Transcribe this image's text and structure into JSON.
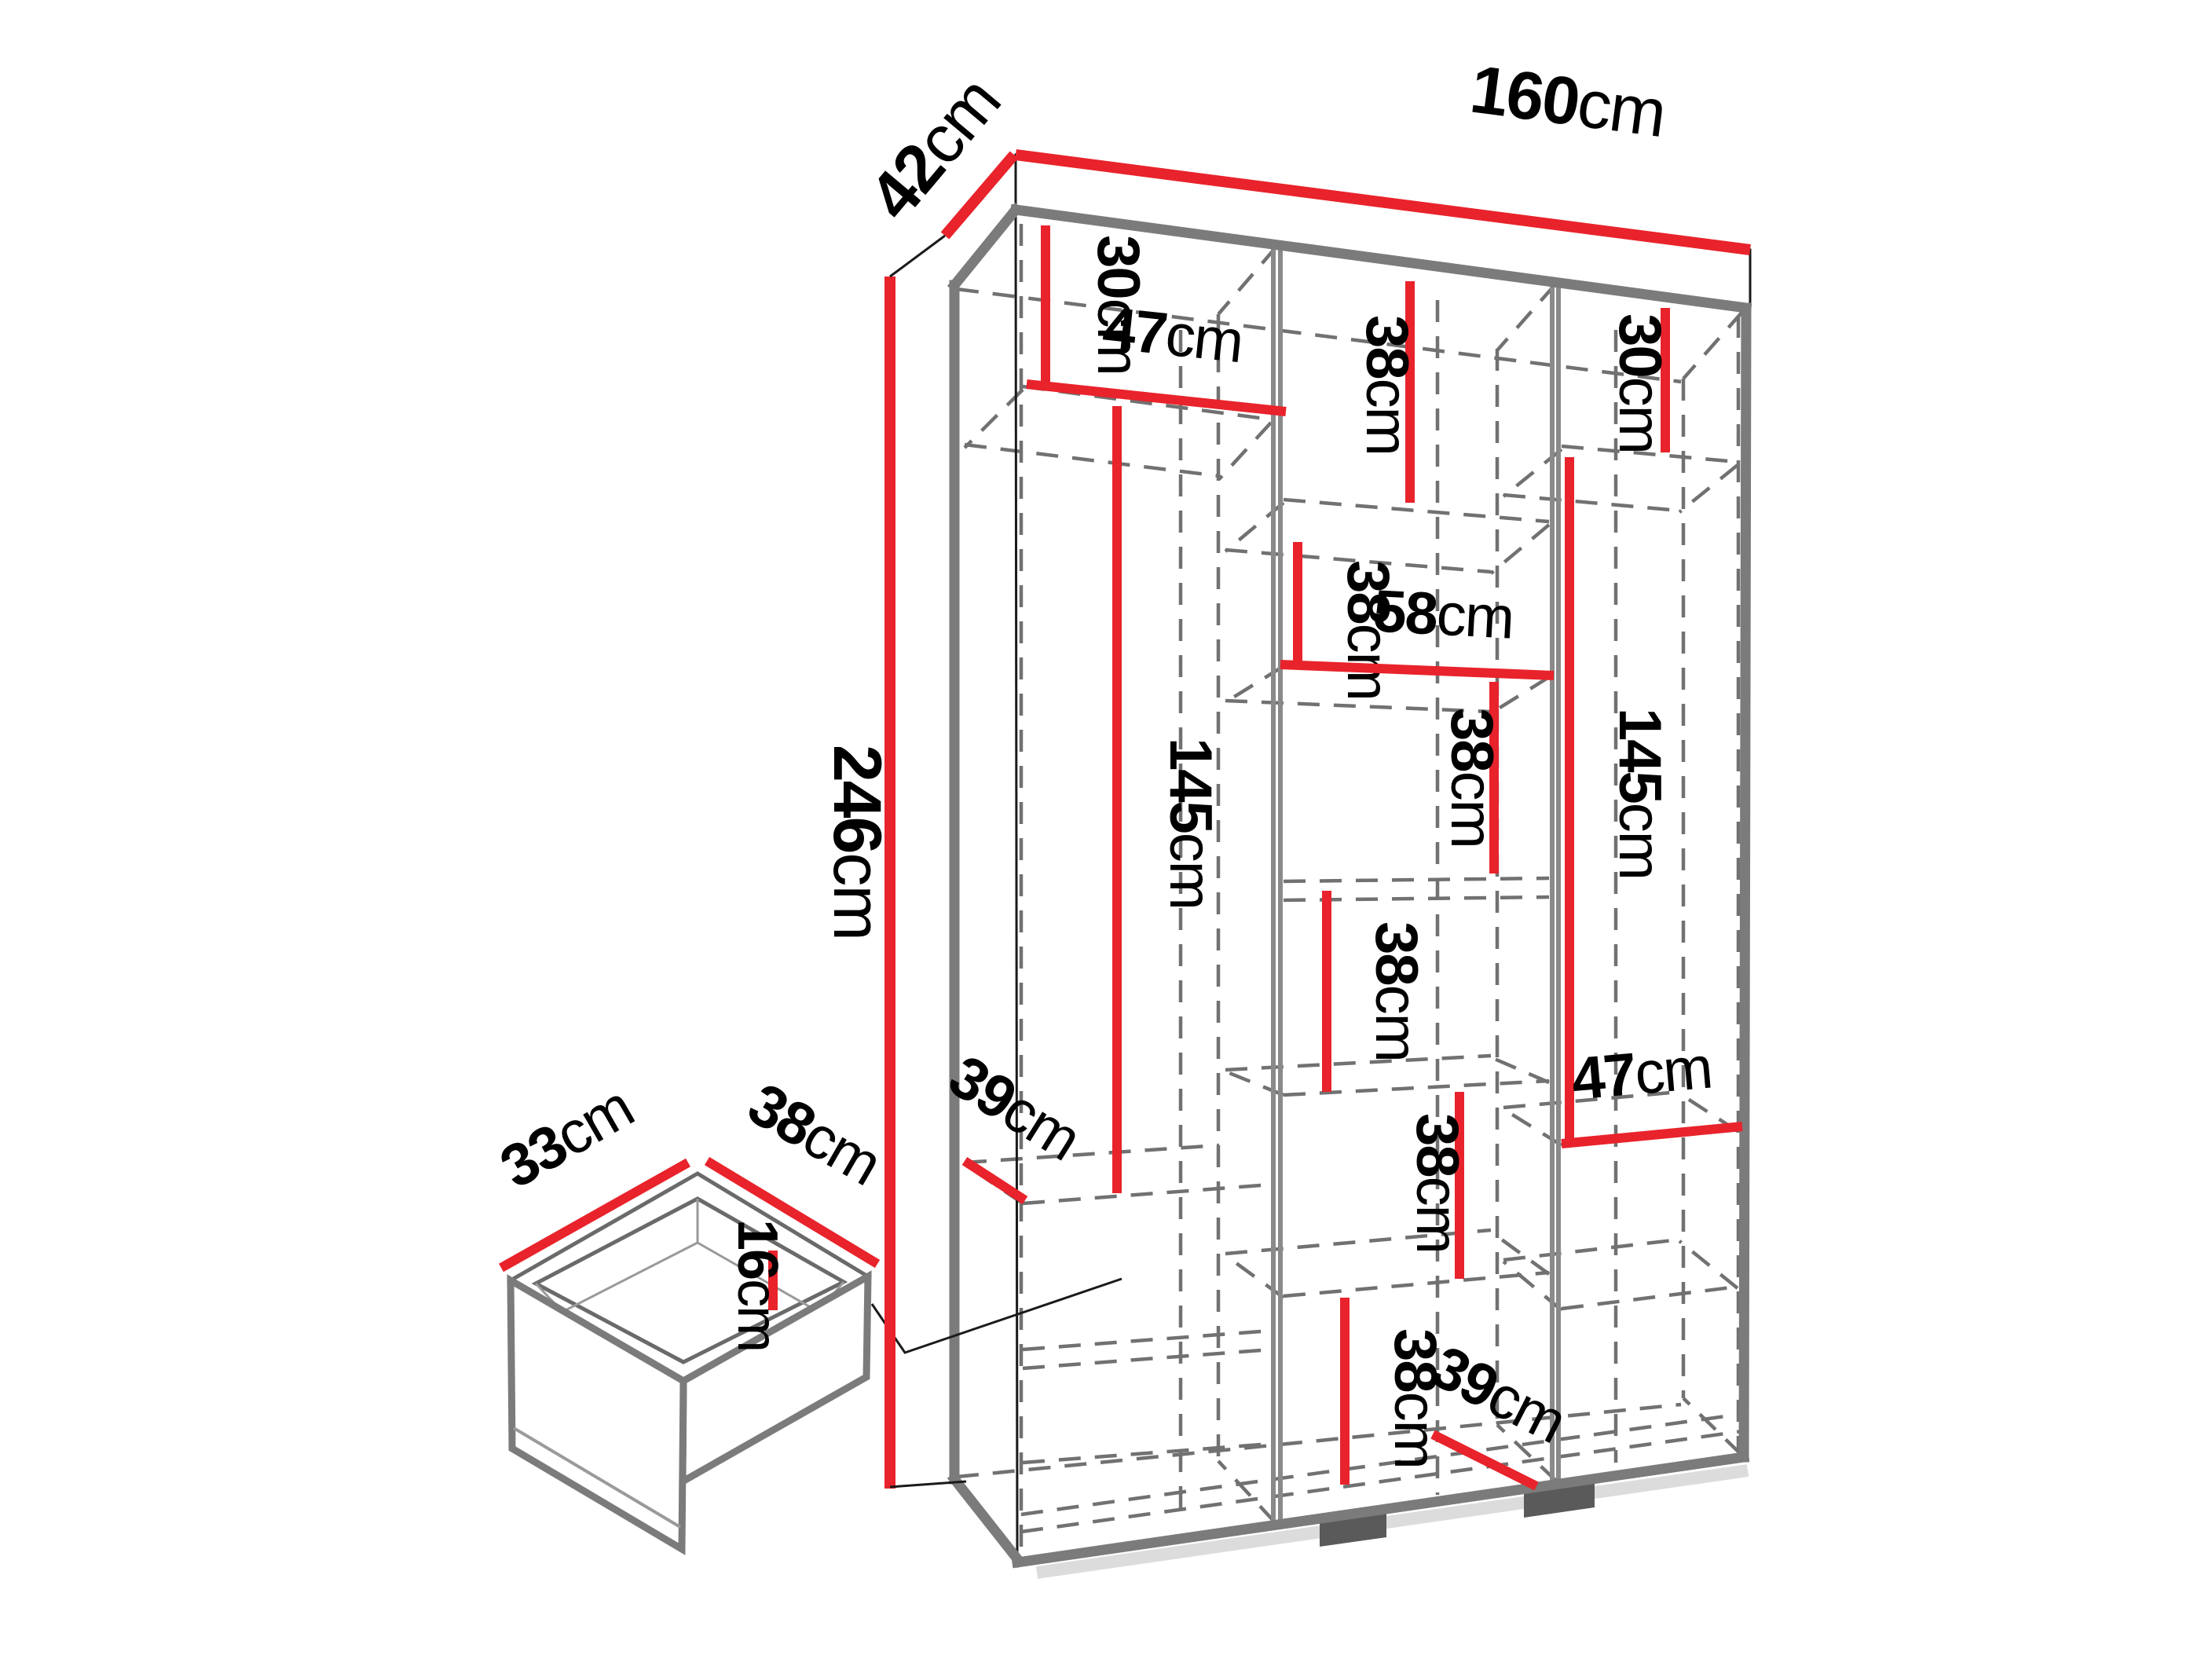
{
  "title": "Wardrobe dimension diagram",
  "colors": {
    "accent_red": "#e8232b",
    "frame_gray": "#7b7b7b",
    "dash_gray": "#717171"
  },
  "wardrobe": {
    "overall": {
      "width": {
        "value": "160",
        "unit": "cm"
      },
      "depth": {
        "value": "42",
        "unit": "cm"
      },
      "height": {
        "value": "246",
        "unit": "cm"
      }
    },
    "left_column": {
      "top_compartment_height": {
        "value": "30",
        "unit": "cm"
      },
      "width": {
        "value": "47",
        "unit": "cm"
      },
      "hanging_height": {
        "value": "145",
        "unit": "cm"
      },
      "shelf_depth": {
        "value": "39",
        "unit": "cm"
      }
    },
    "middle_column": {
      "width": {
        "value": "58",
        "unit": "cm"
      },
      "shelf_heights": [
        {
          "value": "38",
          "unit": "cm"
        },
        {
          "value": "38",
          "unit": "cm"
        },
        {
          "value": "38",
          "unit": "cm"
        },
        {
          "value": "38",
          "unit": "cm"
        },
        {
          "value": "38",
          "unit": "cm"
        },
        {
          "value": "38",
          "unit": "cm"
        }
      ],
      "bottom_shelf_depth": {
        "value": "39",
        "unit": "cm"
      }
    },
    "right_column": {
      "top_compartment_height": {
        "value": "30",
        "unit": "cm"
      },
      "hanging_height": {
        "value": "145",
        "unit": "cm"
      },
      "width": {
        "value": "47",
        "unit": "cm"
      }
    },
    "drawer": {
      "inner_width": {
        "value": "33",
        "unit": "cm"
      },
      "inner_depth": {
        "value": "38",
        "unit": "cm"
      },
      "inner_height": {
        "value": "16",
        "unit": "cm"
      }
    }
  }
}
